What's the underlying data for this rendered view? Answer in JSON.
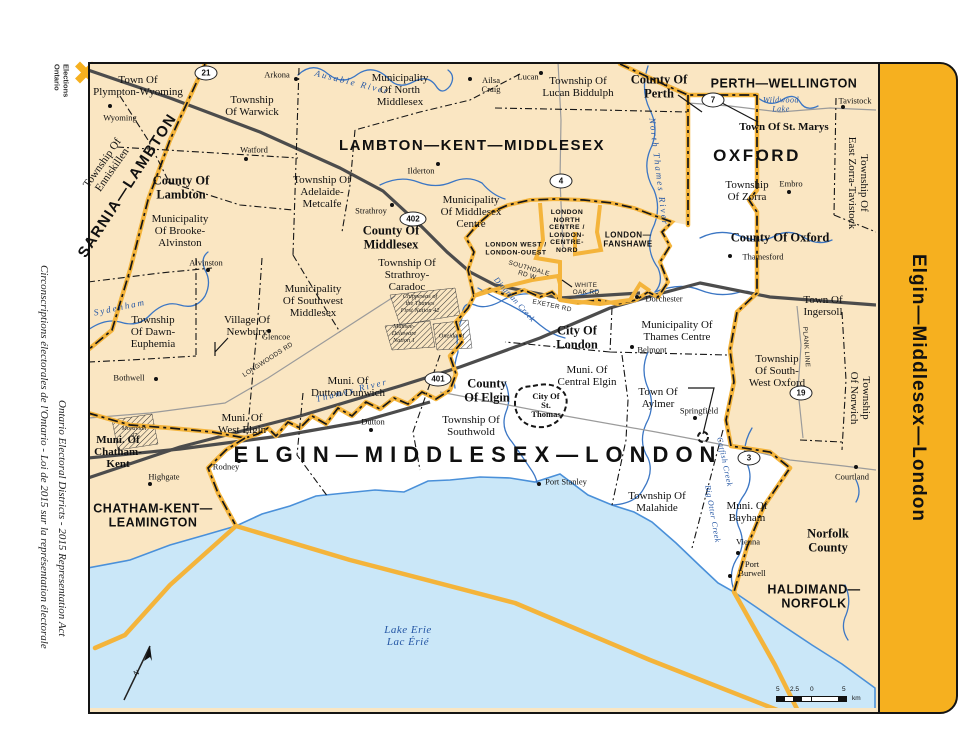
{
  "branding": {
    "logo_line1": "Elections",
    "logo_line2": "Ontario"
  },
  "margin_titles": {
    "english": "Ontario Electoral Districts - 2015 Representation Act",
    "french": "Circonscriptions électorales de l'Ontario - Loi de 2015 sur la représentation électorale"
  },
  "district_tab": {
    "label": "Elgin—Middlesex—London"
  },
  "colors": {
    "beige": "#FAE6C2",
    "lake": "#CAE7F8",
    "shore": "#4A90D9",
    "river": "#3B76C4",
    "boundary_yellow": "#F4B43B",
    "tab_yellow": "#F6B01F",
    "road_major": "#4C4C4C",
    "road_minor": "#9B9B9B",
    "water_text": "#2456A4"
  },
  "scale_bar": {
    "labels": [
      "5",
      "2.5",
      "0",
      "5"
    ],
    "unit": "km"
  },
  "compass": {
    "label": "N"
  },
  "map": {
    "labels": [
      {
        "t": "SARNIA—LAMBTON",
        "x": 128,
        "y": 186,
        "r": -57,
        "c": "dist big2"
      },
      {
        "t": "LAMBTON—KENT—MIDDLESEX",
        "x": 472,
        "y": 146,
        "c": "dist big2"
      },
      {
        "t": "PERTH—WELLINGTON",
        "x": 784,
        "y": 84,
        "c": "dist"
      },
      {
        "t": "OXFORD",
        "x": 757,
        "y": 156,
        "c": "dist oxford"
      },
      {
        "t": "CHATHAM-KENT—\nLEAMINGTON",
        "x": 153,
        "y": 516,
        "c": "dist"
      },
      {
        "t": "HALDIMAND—\nNORFOLK",
        "x": 814,
        "y": 597,
        "c": "dist"
      },
      {
        "t": "ELGIN—MIDDLESEX—LONDON",
        "x": 478,
        "y": 455,
        "c": "dist title"
      },
      {
        "t": "LONDON\nNORTH\nCENTRE /\nLONDON-\nCENTRE-\nNORD",
        "x": 567,
        "y": 232,
        "c": "dist ldn"
      },
      {
        "t": "LONDON WEST /\nLONDON-OUEST",
        "x": 516,
        "y": 249,
        "c": "dist ldn"
      },
      {
        "t": "LONDON—\nFANSHAWE",
        "x": 628,
        "y": 240,
        "c": "dist ldn2"
      },
      {
        "t": "County Of\nLambton",
        "x": 181,
        "y": 188,
        "c": "county"
      },
      {
        "t": "County Of\nMiddlesex",
        "x": 391,
        "y": 238,
        "c": "county"
      },
      {
        "t": "County Of\nPerth",
        "x": 659,
        "y": 87,
        "c": "county"
      },
      {
        "t": "County Of Oxford",
        "x": 780,
        "y": 238,
        "c": "county"
      },
      {
        "t": "County\nOf Elgin",
        "x": 487,
        "y": 391,
        "c": "county"
      },
      {
        "t": "Norfolk\nCounty",
        "x": 828,
        "y": 541,
        "c": "county"
      },
      {
        "t": "City Of\nLondon",
        "x": 577,
        "y": 338,
        "c": "county"
      },
      {
        "t": "Town Of St. Marys",
        "x": 784,
        "y": 128,
        "c": "county sm"
      },
      {
        "t": "Town Of\nPlympton-Wyoming",
        "x": 138,
        "y": 87,
        "c": "muni"
      },
      {
        "t": "Township\nOf Warwick",
        "x": 252,
        "y": 107,
        "c": "muni"
      },
      {
        "t": "Municipality\nOf North\nMiddlesex",
        "x": 400,
        "y": 91,
        "c": "muni"
      },
      {
        "t": "Township Of\nLucan Biddulph",
        "x": 578,
        "y": 88,
        "c": "muni"
      },
      {
        "t": "Township Of\nEnniskillen",
        "x": 108,
        "y": 167,
        "r": -55,
        "c": "muni"
      },
      {
        "t": "Municipality\nOf Brooke-\nAlvinston",
        "x": 180,
        "y": 232,
        "c": "muni"
      },
      {
        "t": "Township Of\nAdelaide-\nMetcalfe",
        "x": 322,
        "y": 193,
        "c": "muni"
      },
      {
        "t": "Municipality\nOf Middlesex\nCentre",
        "x": 471,
        "y": 213,
        "c": "muni"
      },
      {
        "t": "Township Of\nStrathroy-\nCaradoc",
        "x": 407,
        "y": 276,
        "c": "muni"
      },
      {
        "t": "Municipality\nOf Southwest\nMiddlesex",
        "x": 313,
        "y": 302,
        "c": "muni"
      },
      {
        "t": "Township\nOf Dawn-\nEuphemia",
        "x": 153,
        "y": 333,
        "c": "muni"
      },
      {
        "t": "Village Of\nNewbury",
        "x": 247,
        "y": 327,
        "c": "muni"
      },
      {
        "t": "Muni. Of\nChatham-\nKent",
        "x": 118,
        "y": 453,
        "c": "muni b"
      },
      {
        "t": "Muni. Of\nWest Elgin",
        "x": 242,
        "y": 425,
        "c": "muni"
      },
      {
        "t": "Muni. Of\nDutton/Dunwich",
        "x": 348,
        "y": 388,
        "c": "muni"
      },
      {
        "t": "Township Of\nSouthwold",
        "x": 471,
        "y": 427,
        "c": "muni"
      },
      {
        "t": "Muni. Of\nCentral Elgin",
        "x": 587,
        "y": 377,
        "c": "muni"
      },
      {
        "t": "City Of\nSt.\nThomas",
        "x": 546,
        "y": 406,
        "c": "muni st"
      },
      {
        "t": "Municipality Of\nThames Centre",
        "x": 677,
        "y": 332,
        "c": "muni"
      },
      {
        "t": "Town Of\nAylmer",
        "x": 658,
        "y": 399,
        "c": "muni"
      },
      {
        "t": "Township Of\nMalahide",
        "x": 657,
        "y": 503,
        "c": "muni"
      },
      {
        "t": "Muni. Of\nBayham",
        "x": 747,
        "y": 513,
        "c": "muni"
      },
      {
        "t": "Township\nOf South-\nWest Oxford",
        "x": 777,
        "y": 372,
        "c": "muni"
      },
      {
        "t": "Town Of\nIngersoll",
        "x": 823,
        "y": 307,
        "c": "muni"
      },
      {
        "t": "Township\nOf Zorra",
        "x": 747,
        "y": 192,
        "c": "muni"
      },
      {
        "t": "Township Of\nEast Zorra-Tavistock",
        "x": 857,
        "y": 183,
        "r": 90,
        "c": "muni"
      },
      {
        "t": "Township\nOf Norwich",
        "x": 859,
        "y": 398,
        "r": 90,
        "c": "muni"
      },
      {
        "t": "Wyoming",
        "x": 120,
        "y": 118,
        "c": "town"
      },
      {
        "t": "Arkona",
        "x": 277,
        "y": 75,
        "c": "town"
      },
      {
        "t": "Watford",
        "x": 254,
        "y": 150,
        "c": "town"
      },
      {
        "t": "Ailsa\nCraig",
        "x": 491,
        "y": 85,
        "c": "town"
      },
      {
        "t": "Lucan",
        "x": 528,
        "y": 77,
        "c": "town"
      },
      {
        "t": "Ilderton",
        "x": 421,
        "y": 171,
        "c": "town"
      },
      {
        "t": "Strathroy",
        "x": 371,
        "y": 211,
        "c": "town"
      },
      {
        "t": "Alvinston",
        "x": 206,
        "y": 263,
        "c": "town"
      },
      {
        "t": "Glencoe",
        "x": 276,
        "y": 337,
        "c": "town"
      },
      {
        "t": "Bothwell",
        "x": 129,
        "y": 378,
        "c": "town"
      },
      {
        "t": "Tavistock",
        "x": 855,
        "y": 101,
        "c": "town"
      },
      {
        "t": "Embro",
        "x": 791,
        "y": 184,
        "c": "town"
      },
      {
        "t": "Thamesford",
        "x": 763,
        "y": 257,
        "c": "town"
      },
      {
        "t": "Dorchester",
        "x": 664,
        "y": 299,
        "c": "town"
      },
      {
        "t": "Belmont",
        "x": 652,
        "y": 350,
        "c": "town"
      },
      {
        "t": "Springfield",
        "x": 699,
        "y": 411,
        "c": "town"
      },
      {
        "t": "Dutton",
        "x": 373,
        "y": 422,
        "c": "town"
      },
      {
        "t": "Rodney",
        "x": 226,
        "y": 467,
        "c": "town"
      },
      {
        "t": "Highgate",
        "x": 164,
        "y": 477,
        "c": "town"
      },
      {
        "t": "Port Stanley",
        "x": 566,
        "y": 482,
        "c": "town"
      },
      {
        "t": "Vienna",
        "x": 748,
        "y": 542,
        "c": "town"
      },
      {
        "t": "Port\nBurwell",
        "x": 752,
        "y": 569,
        "c": "town"
      },
      {
        "t": "Courtland",
        "x": 852,
        "y": 477,
        "c": "town"
      },
      {
        "t": "Ausable River",
        "x": 352,
        "y": 83,
        "r": 14,
        "c": "water sp"
      },
      {
        "t": "North Thames River",
        "x": 658,
        "y": 172,
        "r": 83,
        "c": "water sp"
      },
      {
        "t": "Wildwood\nLake",
        "x": 781,
        "y": 105,
        "c": "water tiny"
      },
      {
        "t": "Sydenham",
        "x": 120,
        "y": 308,
        "r": -12,
        "c": "water sp"
      },
      {
        "t": "Thames River",
        "x": 352,
        "y": 391,
        "r": -14,
        "c": "water sp"
      },
      {
        "t": "Dingman Creek",
        "x": 514,
        "y": 300,
        "r": 48,
        "c": "water tiny"
      },
      {
        "t": "Catfish Creek",
        "x": 724,
        "y": 462,
        "r": 78,
        "c": "water tiny"
      },
      {
        "t": "Big Otter Creek",
        "x": 712,
        "y": 514,
        "r": 80,
        "c": "water tiny"
      },
      {
        "t": "Lake Erie\nLac Érié",
        "x": 408,
        "y": 637,
        "c": "water lake"
      },
      {
        "t": "SOUTHDALE\nRD W",
        "x": 528,
        "y": 272,
        "r": 16,
        "c": "road"
      },
      {
        "t": "WHITE\nOAK RD",
        "x": 586,
        "y": 289,
        "c": "road"
      },
      {
        "t": "EXETER RD",
        "x": 552,
        "y": 306,
        "r": 12,
        "c": "road"
      },
      {
        "t": "LONGWOODS RD",
        "x": 268,
        "y": 360,
        "r": -33,
        "c": "road"
      },
      {
        "t": "PLANK LINE",
        "x": 806,
        "y": 347,
        "r": 86,
        "c": "road"
      },
      {
        "t": "Chippewas of\nthe Thames\nFirst Nation 42",
        "x": 420,
        "y": 304,
        "c": "fn"
      },
      {
        "t": "Munsee-\nDelaware\nNation 1",
        "x": 404,
        "y": 334,
        "c": "fn"
      },
      {
        "t": "Oneida 41",
        "x": 452,
        "y": 337,
        "c": "fn"
      },
      {
        "t": "Moravian\n47",
        "x": 134,
        "y": 433,
        "c": "fn"
      }
    ],
    "dots": [
      [
        110,
        106
      ],
      [
        296,
        79
      ],
      [
        246,
        159
      ],
      [
        470,
        79
      ],
      [
        541,
        73
      ],
      [
        438,
        164
      ],
      [
        392,
        205
      ],
      [
        208,
        270
      ],
      [
        269,
        331
      ],
      [
        156,
        379
      ],
      [
        843,
        107
      ],
      [
        789,
        192
      ],
      [
        730,
        256
      ],
      [
        637,
        297
      ],
      [
        632,
        347
      ],
      [
        695,
        418
      ],
      [
        371,
        430
      ],
      [
        239,
        461
      ],
      [
        150,
        484
      ],
      [
        539,
        484
      ],
      [
        738,
        553
      ],
      [
        730,
        576
      ],
      [
        856,
        467
      ]
    ],
    "highways": [
      {
        "n": "21",
        "x": 206,
        "y": 73
      },
      {
        "n": "402",
        "x": 413,
        "y": 219
      },
      {
        "n": "4",
        "x": 561,
        "y": 181
      },
      {
        "n": "7",
        "x": 713,
        "y": 100
      },
      {
        "n": "401",
        "x": 438,
        "y": 379
      },
      {
        "n": "19",
        "x": 801,
        "y": 393
      },
      {
        "n": "3",
        "x": 749,
        "y": 458
      }
    ]
  }
}
